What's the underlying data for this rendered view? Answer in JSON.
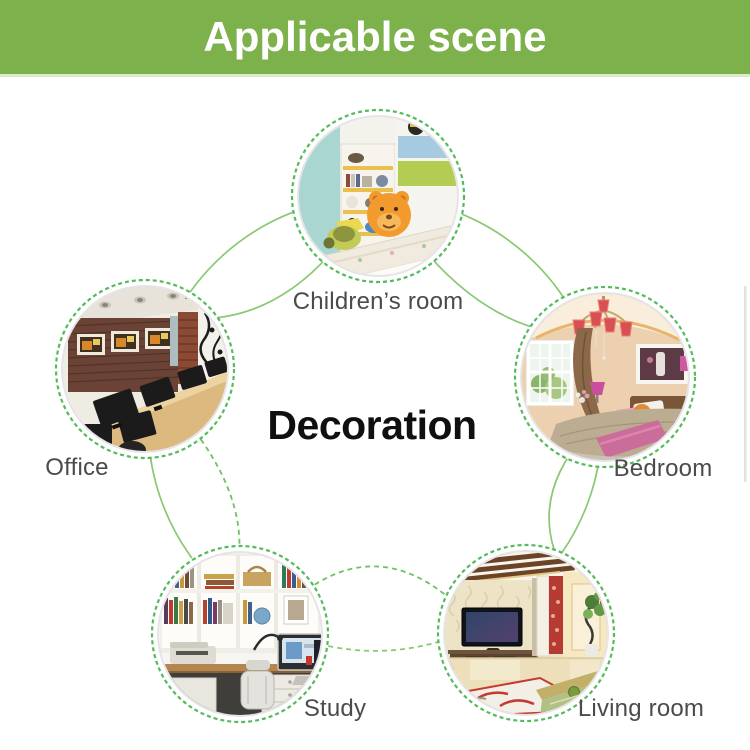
{
  "header": {
    "title": "Applicable scene"
  },
  "center": {
    "label": "Decoration"
  },
  "scenes": [
    {
      "id": "childrens-room",
      "label": "Children’s room",
      "photo": "children's bedroom with toy shelves, plush bear and bed"
    },
    {
      "id": "office",
      "label": "Office",
      "photo": "office room with brick wall, three framed pictures and monitors on a wooden desk"
    },
    {
      "id": "bedroom",
      "label": "Bedroom",
      "photo": "warm bedroom with red chandelier, window, curtain and pink-accented bed"
    },
    {
      "id": "study",
      "label": "Study",
      "photo": "home study with white bookshelves, computer, printer and chair"
    },
    {
      "id": "living-room",
      "label": "Living room",
      "photo": "living room with TV on low cabinet, plant and glass table"
    }
  ],
  "theme": {
    "header_bg": "#7db14c",
    "header_text": "#ffffff",
    "line_green": "#8ac872",
    "dash_green": "#54bb5c",
    "label_color": "#4b4b4b",
    "center_label_color": "#101010"
  }
}
